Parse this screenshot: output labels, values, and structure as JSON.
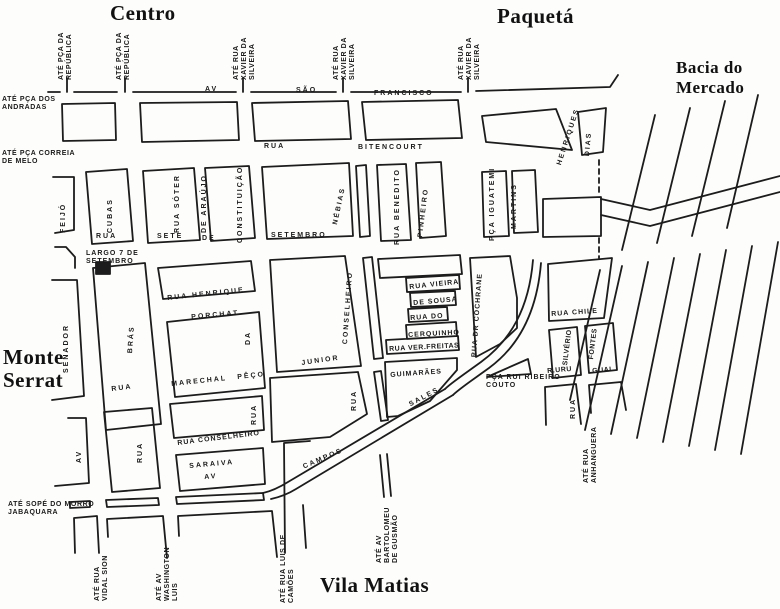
{
  "map": {
    "titles": {
      "centro": "Centro",
      "paqueta": "Paquetá",
      "bacia_mercado": "Bacia do Mercado",
      "monte_serrat": "Monte Serrat",
      "vila_matias": "Vila Matias"
    },
    "edge_labels": {
      "ate_pca_republica_1": "ATÉ PÇA DA REPÚBLICA",
      "ate_pca_republica_2": "ATÉ PÇA DA REPÚBLICA",
      "ate_rua_xavier_1": "ATÉ RUA XAVIER DA SILVEIRA",
      "ate_rua_xavier_2": "ATÉ RUA XAVIER DA SILVEIRA",
      "ate_rua_xavier_3": "ATÉ RUA XAVIER DA SILVEIRA",
      "ate_pca_andradas": "ATÉ PÇA DOS ANDRADAS",
      "ate_pca_correia_melo": "ATÉ PÇA CORREIA DE MELO",
      "ate_sope_jabaquara": "ATÉ SOPÉ DO MORRO JABAQUARA",
      "ate_rua_vidal_sion": "ATÉ RUA VIDAL SION",
      "ate_av_washington_luis": "ATÉ AV WASHINGTON LUIS",
      "ate_rua_luis_camoes": "ATÉ RUA LUIS DE CAMÕES",
      "ate_av_bartolomeu": "ATÉ AV BARTOLOMEU DE GUSMÃO",
      "ate_rua_anhanguera": "ATÉ RUA ANHANGUERA"
    },
    "street_labels": {
      "av_sf_av": "AV",
      "av_sf_sao": "SÃO",
      "av_sf_francisco": "FRANCISCO",
      "bit_rua": "RUA",
      "bit_bitencourt": "BITENCOURT",
      "feijo": "FEIJÓ",
      "cubas": "CUBAS",
      "rua_soter": "RUA SÓTER",
      "de_araujo": "DE ARAÚJO",
      "constituicao": "CONSTITUIÇÃO",
      "nebias": "NÉBIAS",
      "rua_benedito": "RUA BENEDITO",
      "pinheiro": "PINHEIRO",
      "pca_iguatemi": "PÇA IGUATEMI",
      "martins": "MARTINS",
      "henriques": "HENRIQUES",
      "dias": "DIAS",
      "ss_rua": "RUA",
      "ss_sete": "SETE",
      "ss_de": "DE",
      "ss_setembro": "SETEMBRO",
      "largo_7_setembro": "LARGO 7 DE SETEMBRO",
      "senador": "SENADOR",
      "bras": "BRÁS",
      "rua_bras": "RUA",
      "av_senador": "AV",
      "rua_d2": "RUA",
      "rua_henrique": "RUA HENRIQUE",
      "porchat": "PORCHAT",
      "da": "DA",
      "marechal": "MARECHAL",
      "peco": "PÊÇO",
      "junior": "JUNIOR",
      "conselheiro": "CONSELHEIRO",
      "rua_vieira": "RUA VIEIRA",
      "de_sousa": "DE SOUSA",
      "rua_do": "RUA DO",
      "cerquinho": "CERQUINHO",
      "rua_ver_freitas": "RUA VER.FREITAS",
      "rua_dr_cochrane": "RUA DR COCHRANE",
      "guimaraes": "GUIMARÃES",
      "sales": "SALES",
      "rua_nebias_s": "RUA",
      "campos": "CAMPOS",
      "rua_conselheiro": "RUA CONSELHEIRO",
      "saraiva": "SARAIVA",
      "av_saraiva": "AV",
      "rua_d3": "RUA",
      "rua_chile": "RUA CHILE",
      "silverio": "SILVÉRIO",
      "r_uru": "R.URU",
      "fontes": "FONTES",
      "guai": "GUAI",
      "pca_rui_ribeiro_couto": "PÇA RUI RIBEIRO COUTO",
      "rua_right": "RUA"
    }
  }
}
